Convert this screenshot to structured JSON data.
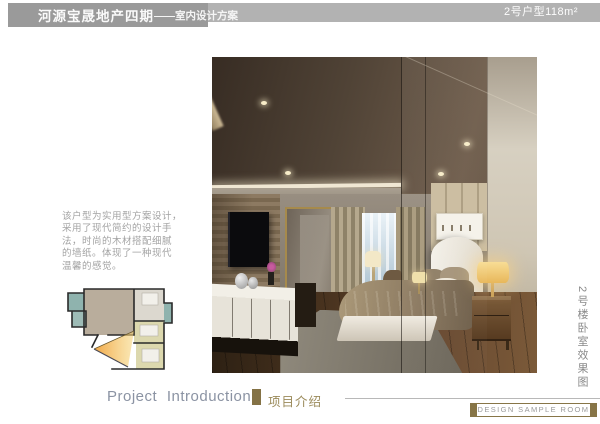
{
  "header": {
    "title_main": "河源宝晟地产四期",
    "title_sub": "——室内设计方案",
    "unit_label": "2号户型118m²"
  },
  "description": {
    "lines": [
      "该户型为实用型方案设计，",
      "采用了现代简约的设计手",
      "法，时尚的木材搭配细腻",
      "的墙纸。体现了一种现代",
      "温馨的感觉。"
    ]
  },
  "photo_caption": "2号楼卧室效果图",
  "footer": {
    "english_title": "Project  Introduction",
    "chinese_title": "项目介绍",
    "sample_room_label": "DESIGN SAMPLE ROOM"
  },
  "colors": {
    "header_block_gray": "#9a9a9a",
    "header_band_gray": "#b2b2b2",
    "accent_olive": "#847245",
    "footer_text_blue_gray": "#8b93a3",
    "caption_gray": "#8a8a8a",
    "floorplan_cone_orange": "#f0a23c",
    "floorplan_teal": "#8fb3ae",
    "floorplan_tan": "#b9ad9c",
    "floorplan_yellow": "#dcd8ae"
  }
}
